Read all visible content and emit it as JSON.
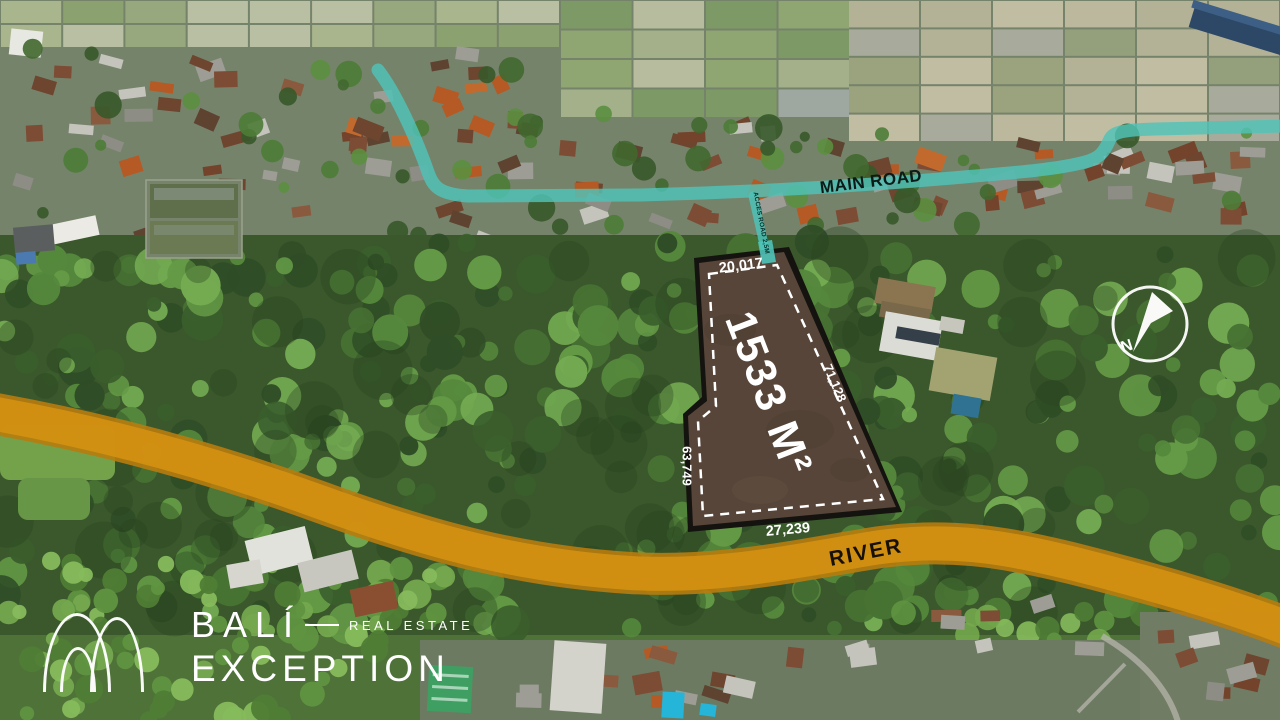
{
  "image_type": "aerial-drone-land-listing",
  "overlay_labels": {
    "main_road": "MAIN ROAD",
    "access_road": "ACCES ROAD 2,5M",
    "river": "RIVER",
    "compass_north": "N"
  },
  "plot": {
    "area": "1533 M²",
    "side_top": "20,017",
    "side_right": "71,128",
    "side_left": "63,749",
    "side_bottom": "27,239"
  },
  "logo": {
    "line1": "BALÍ",
    "tagline": "REAL ESTATE",
    "line2": "EXCEPTION"
  },
  "colors": {
    "road": "#4fc3b8",
    "river": "#d29012",
    "river_edge": "#b87c0e",
    "plot_fill": "#5b483b",
    "plot_border": "#15130f",
    "dash": "#ffffff"
  }
}
